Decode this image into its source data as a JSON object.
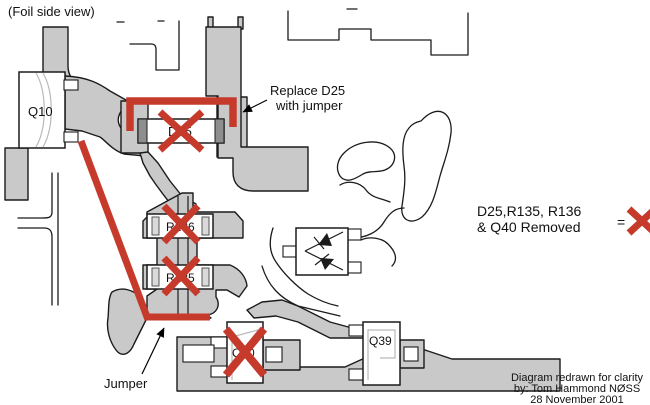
{
  "title": "(Foil side view)",
  "colors": {
    "foil_gray": "#C9C9C9",
    "removed_red": "#C63A2C",
    "component_cap_gray": "#8E8E8E",
    "outline_black": "#1B1B1B",
    "background": "#FFFFFF"
  },
  "components": {
    "q10": "Q10",
    "d25": "D25",
    "r136": "R136",
    "r135": "R135",
    "q40": "Q40",
    "q39": "Q39"
  },
  "annotations": {
    "replace_line1": "Replace D25",
    "replace_line2": "with jumper",
    "jumper_label": "Jumper",
    "legend_line1": "D25,R135, R136",
    "legend_line2": "& Q40 Removed",
    "legend_equals": "=",
    "credit_line1": "Diagram redrawn for clarity",
    "credit_line2": "by: Tom Hammond  NØSS",
    "credit_line3": "28 November 2001"
  },
  "icons": {
    "removed_x_icon": "red X cross marking removed component",
    "arrow_icon": "black annotation arrow",
    "diode_pair_icon": "dual diode symbols inside package"
  }
}
